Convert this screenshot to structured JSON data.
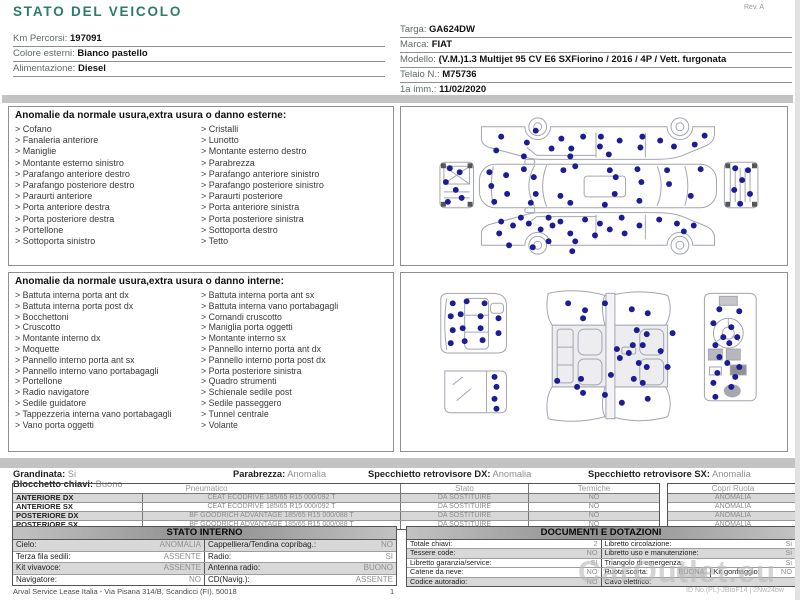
{
  "title": "STATO DEL VEICOLO",
  "colors": {
    "accent": "#2e7b6b",
    "dot": "#1c1c96",
    "bar": "#c3c3c3"
  },
  "meta": {
    "rev": "Rev. A",
    "footer": "Arval Service Lease Italia - Via Pisana 314/B, Scandicci (FI), 50018",
    "page": "1",
    "watermark": "CarOutlet.eu",
    "watermark_id": "ID No.(PL)-JBtoF14 | 2Nw24bw"
  },
  "info_left": [
    {
      "label": "Km Percorsi:",
      "value": "197091"
    },
    {
      "label": "Colore esterni:",
      "value": "Bianco pastello"
    },
    {
      "label": "Alimentazione:",
      "value": "Diesel"
    }
  ],
  "info_right": [
    {
      "label": "Targa:",
      "value": "GA624DW"
    },
    {
      "label": "Marca:",
      "value": "FIAT"
    },
    {
      "label": "Modello:",
      "value": "(V.M.)1.3 Multijet 95 CV E6 SXFiorino / 2016 / 4P / Vett. furgonata"
    },
    {
      "label": "Telaio N.:",
      "value": "M75736"
    },
    {
      "label": "1a imm.:",
      "value": "11/02/2020"
    }
  ],
  "sections": {
    "exterior": {
      "title": "Anomalie da normale usura,extra usura o danno esterne:",
      "col1": [
        "Cofano",
        "Fanaleria anteriore",
        "Maniglie",
        "Montante esterno sinistro",
        "Parafango anteriore destro",
        "Parafango posteriore destro",
        "Paraurti anteriore",
        "Porta anteriore destra",
        "Porta posteriore destra",
        "Portellone",
        "Sottoporta sinistro"
      ],
      "col2": [
        "Cristalli",
        "Lunotto",
        "Montante esterno destro",
        "Parabrezza",
        "Parafango anteriore sinistro",
        "Parafango posteriore sinistro",
        "Paraurti posteriore",
        "Porta anteriore sinistra",
        "Porta posteriore sinistra",
        "Sottoporta destro",
        "Tetto"
      ],
      "dots": [
        [
          100,
          30
        ],
        [
          126,
          36
        ],
        [
          95,
          44
        ],
        [
          151,
          42
        ],
        [
          161,
          32
        ],
        [
          171,
          42
        ],
        [
          183,
          30
        ],
        [
          200,
          40
        ],
        [
          201,
          30
        ],
        [
          220,
          34
        ],
        [
          241,
          41
        ],
        [
          243,
          30
        ],
        [
          261,
          34
        ],
        [
          275,
          40
        ],
        [
          296,
          38
        ],
        [
          306,
          29
        ],
        [
          123,
          50
        ],
        [
          170,
          50
        ],
        [
          209,
          48
        ],
        [
          135,
          24
        ],
        [
          88,
          66
        ],
        [
          105,
          69
        ],
        [
          90,
          80
        ],
        [
          106,
          88
        ],
        [
          93,
          96
        ],
        [
          123,
          63
        ],
        [
          133,
          71
        ],
        [
          135,
          88
        ],
        [
          130,
          97
        ],
        [
          163,
          64
        ],
        [
          175,
          60
        ],
        [
          170,
          97
        ],
        [
          205,
          99
        ],
        [
          210,
          64
        ],
        [
          216,
          71
        ],
        [
          238,
          63
        ],
        [
          242,
          76
        ],
        [
          215,
          88
        ],
        [
          268,
          64
        ],
        [
          302,
          63
        ],
        [
          270,
          78
        ],
        [
          292,
          90
        ],
        [
          240,
          95
        ],
        [
          160,
          90
        ],
        [
          100,
          116
        ],
        [
          98,
          128
        ],
        [
          112,
          120
        ],
        [
          120,
          112
        ],
        [
          128,
          118
        ],
        [
          140,
          124
        ],
        [
          148,
          112
        ],
        [
          152,
          120
        ],
        [
          160,
          116
        ],
        [
          170,
          128
        ],
        [
          148,
          136
        ],
        [
          175,
          136
        ],
        [
          185,
          114
        ],
        [
          200,
          118
        ],
        [
          195,
          130
        ],
        [
          210,
          124
        ],
        [
          222,
          112
        ],
        [
          225,
          128
        ],
        [
          240,
          120
        ],
        [
          260,
          114
        ],
        [
          278,
          118
        ],
        [
          285,
          126
        ],
        [
          295,
          120
        ],
        [
          172,
          146
        ],
        [
          132,
          142
        ],
        [
          108,
          140
        ],
        [
          48,
          62
        ],
        [
          58,
          66
        ],
        [
          44,
          76
        ],
        [
          54,
          84
        ],
        [
          46,
          96
        ],
        [
          60,
          92
        ],
        [
          337,
          62
        ],
        [
          350,
          64
        ],
        [
          344,
          74
        ],
        [
          336,
          84
        ],
        [
          352,
          88
        ],
        [
          342,
          98
        ]
      ]
    },
    "interior": {
      "title": "Anomalie da normale usura,extra usura o danno interne:",
      "col1": [
        "Battuta interna porta ant dx",
        "Battuta interna porta post dx",
        "Bocchettoni",
        "Cruscotto",
        "Montante interno dx",
        "Moquette",
        "Pannello interno porta ant sx",
        "Pannello interno vano portabagagli",
        "Portellone",
        "Radio navigatore",
        "Sedile guidatore",
        "Tappezzeria interna vano portabagagli",
        "Vano porta oggetti"
      ],
      "col2": [
        "Battuta interna porta ant sx",
        "Battuta interna vano portabagagli",
        "Comandi cruscotto",
        "Maniglia porta oggetti",
        "Montante interno sx",
        "Pannello interno porta ant dx",
        "Pannello interno porta post dx",
        "Porta posteriore sinistra",
        "Quadro strumenti",
        "Schienale sedile post",
        "Sedile passeggero",
        "Tunnel centrale",
        "Volante"
      ],
      "dots": [
        [
          52,
          30
        ],
        [
          66,
          28
        ],
        [
          84,
          30
        ],
        [
          50,
          43
        ],
        [
          60,
          41
        ],
        [
          80,
          43
        ],
        [
          52,
          57
        ],
        [
          62,
          55
        ],
        [
          80,
          55
        ],
        [
          50,
          70
        ],
        [
          64,
          68
        ],
        [
          82,
          67
        ],
        [
          98,
          45
        ],
        [
          98,
          60
        ],
        [
          94,
          104
        ],
        [
          96,
          114
        ],
        [
          94,
          126
        ],
        [
          96,
          136
        ],
        [
          168,
          30
        ],
        [
          185,
          37
        ],
        [
          183,
          45
        ],
        [
          205,
          30
        ],
        [
          232,
          36
        ],
        [
          248,
          40
        ],
        [
          237,
          57
        ],
        [
          247,
          61
        ],
        [
          273,
          60
        ],
        [
          233,
          72
        ],
        [
          243,
          72
        ],
        [
          229,
          80
        ],
        [
          261,
          78
        ],
        [
          239,
          90
        ],
        [
          247,
          94
        ],
        [
          268,
          94
        ],
        [
          217,
          76
        ],
        [
          220,
          85
        ],
        [
          181,
          106
        ],
        [
          177,
          114
        ],
        [
          211,
          102
        ],
        [
          234,
          106
        ],
        [
          243,
          110
        ],
        [
          205,
          122
        ],
        [
          183,
          120
        ],
        [
          157,
          108
        ],
        [
          222,
          130
        ],
        [
          248,
          126
        ],
        [
          320,
          36
        ],
        [
          340,
          38
        ],
        [
          314,
          50
        ],
        [
          332,
          54
        ],
        [
          324,
          64
        ],
        [
          316,
          72
        ],
        [
          330,
          70
        ],
        [
          338,
          64
        ],
        [
          320,
          84
        ],
        [
          328,
          90
        ],
        [
          318,
          100
        ],
        [
          314,
          110
        ],
        [
          332,
          114
        ],
        [
          316,
          124
        ],
        [
          340,
          94
        ],
        [
          336,
          104
        ]
      ]
    }
  },
  "conditions": {
    "grandinata": {
      "label": "Grandinata:",
      "value": "Si"
    },
    "blocchetto": {
      "label": "Blocchetto chiavi:",
      "value": "Buono"
    },
    "parabrezza": {
      "label": "Parabrezza:",
      "value": "Anomalia"
    },
    "specchietto_dx": {
      "label": "Specchietto retrovisore DX:",
      "value": "Anomalia"
    },
    "specchietto_sx": {
      "label": "Specchietto retrovisore SX:",
      "value": "Anomalia"
    }
  },
  "tyres": {
    "headers": {
      "pneumatico": "Pneumatico",
      "stato": "Stato",
      "termiche": "Termiche",
      "copri": "Copri Ruota"
    },
    "rows": [
      {
        "pos": "ANTERIORE DX",
        "tyre": "CEAT ECODRIVE 185/65 R15 000/092 T",
        "stato": "DA SOSTITUIRE",
        "termiche": "NO",
        "copri": "ANOMALIA"
      },
      {
        "pos": "ANTERIORE SX",
        "tyre": "CEAT ECODRIVE 185/65 R15 000/092 T",
        "stato": "DA SOSTITUIRE",
        "termiche": "NO",
        "copri": "ANOMALIA"
      },
      {
        "pos": "POSTERIORE DX",
        "tyre": "BF GOODRICH ADVANTAGE 185/65 R15 000/088 T",
        "stato": "DA SOSTITUIRE",
        "termiche": "NO",
        "copri": "ANOMALIA"
      },
      {
        "pos": "POSTERIORE SX",
        "tyre": "BF GOODRICH ADVANTAGE 185/65 R15 000/088 T",
        "stato": "DA SOSTITUIRE",
        "termiche": "NO",
        "copri": "ANOMALIA"
      }
    ]
  },
  "stato_interno": {
    "title": "STATO INTERNO",
    "rows": [
      [
        {
          "label": "Cielo:",
          "value": "ANOMALIA"
        },
        {
          "label": "Cappelliera/Tendina copribag.:",
          "value": "NO"
        }
      ],
      [
        {
          "label": "Terza fila sedili:",
          "value": "ASSENTE"
        },
        {
          "label": "Radio:",
          "value": "SI"
        }
      ],
      [
        {
          "label": "Kit vivavoce:",
          "value": "ASSENTE"
        },
        {
          "label": "Antenna radio:",
          "value": "BUONO"
        }
      ],
      [
        {
          "label": "Navigatore:",
          "value": "NO"
        },
        {
          "label": "CD(Navig.):",
          "value": "ASSENTE"
        }
      ]
    ]
  },
  "documenti": {
    "title": "DOCUMENTI E DOTAZIONI",
    "rows": [
      [
        {
          "label": "Totale chiavi:",
          "value": "2"
        },
        {
          "label": "Libretto circolazione:",
          "value": "Si"
        }
      ],
      [
        {
          "label": "Tessere code:",
          "value": "NO"
        },
        {
          "label": "Libretto uso e manutenzione:",
          "value": "Si"
        }
      ],
      [
        {
          "label": "Libretto garanzia/service:",
          "value": "SI"
        },
        {
          "label": "Triangolo di emergenza:",
          "value": "Si"
        }
      ],
      [
        {
          "label": "Catene da neve:",
          "value": "NO"
        },
        {
          "label": "Ruota scorta:",
          "value": "BUONA"
        },
        {
          "label": "Kit gonfiaggio:",
          "value": "NO"
        }
      ],
      [
        {
          "label": "Codice autoradio:",
          "value": "NO"
        },
        {
          "label": "Cavo elettrico:",
          "value": ""
        }
      ]
    ]
  }
}
